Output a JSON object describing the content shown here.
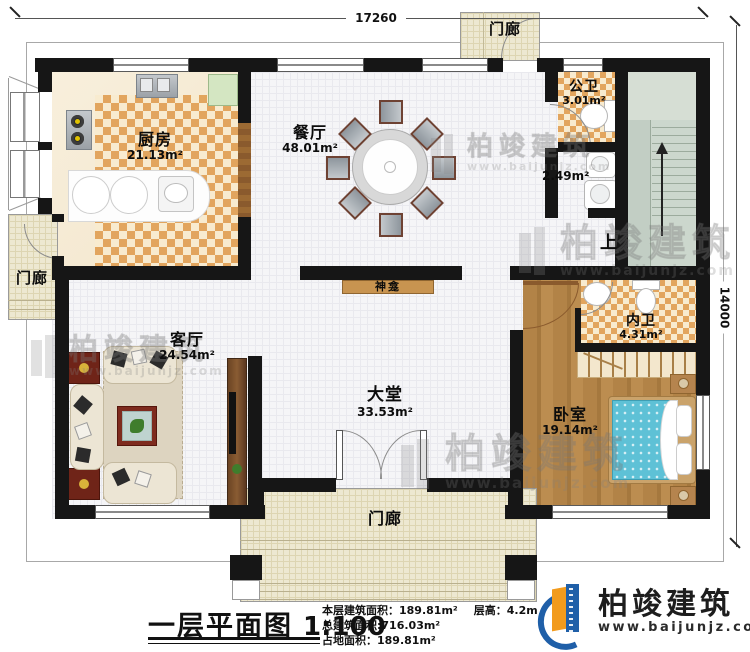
{
  "dimensions": {
    "top_width": "17260",
    "right_height": "14000"
  },
  "rooms": {
    "porch_top": {
      "name": "门廊"
    },
    "kitchen": {
      "name": "厨房",
      "area": "21.13m²"
    },
    "dining": {
      "name": "餐厅",
      "area": "48.01m²"
    },
    "public_bath": {
      "name": "公卫",
      "area": "3.01m²"
    },
    "utility": {
      "area": "2.49m²"
    },
    "stairs": {
      "direction": "上"
    },
    "porch_left": {
      "name": "门廊"
    },
    "shrine": {
      "name": "神龛"
    },
    "living": {
      "name": "客厅",
      "area": "24.54m²"
    },
    "hall": {
      "name": "大堂",
      "area": "33.53m²"
    },
    "ensuite_bath": {
      "name": "内卫",
      "area": "4.31m²"
    },
    "bedroom": {
      "name": "卧室",
      "area": "19.14m²"
    },
    "porch_bottom": {
      "name": "门廊"
    }
  },
  "footer": {
    "title": "一层平面图",
    "scale": "1:100",
    "stats": {
      "line1a": "本层建筑面积：189.81m²",
      "line1b": "层高：4.2m",
      "line2": "总建筑面积:716.03m²",
      "line3": "占地面积：189.81m²"
    }
  },
  "brand": {
    "name": "柏竣建筑",
    "url": "www.baijunjz.com"
  },
  "watermark": {
    "name": "柏竣建筑",
    "url": "www.baijunjz.com"
  },
  "colors": {
    "wall": "#161616",
    "checker_orange": "#e2a55e",
    "wood_floor": "#ab7d42",
    "bed_blue": "#5ec1d6",
    "porch_beige": "#ede8d1",
    "stairs_green": "#ccd7cd",
    "brand_blue": "#1f5fa8",
    "brand_orange": "#f29b1d"
  }
}
